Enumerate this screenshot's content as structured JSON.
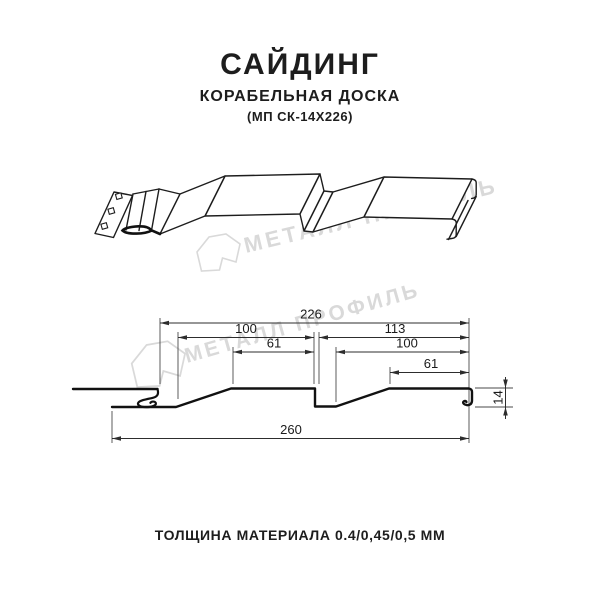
{
  "header": {
    "title": "САЙДИНГ",
    "subtitle": "КОРАБЕЛЬНАЯ ДОСКА",
    "product_code": "(МП СК-14Х226)"
  },
  "watermark": {
    "text": "МЕТАЛЛ ПРОФИЛЬ",
    "color": "#d7d7d7"
  },
  "cross_section": {
    "dim_overall_top": "226",
    "dim_left_pitch": "100",
    "dim_left_flat": "61",
    "dim_right_pitch": "113",
    "dim_right_inner": "100",
    "dim_right_flat": "61",
    "dim_height": "14",
    "dim_overall_bottom": "260"
  },
  "footer": {
    "thickness_note": "ТОЛЩИНА МАТЕРИАЛА 0.4/0,45/0,5 ММ"
  }
}
